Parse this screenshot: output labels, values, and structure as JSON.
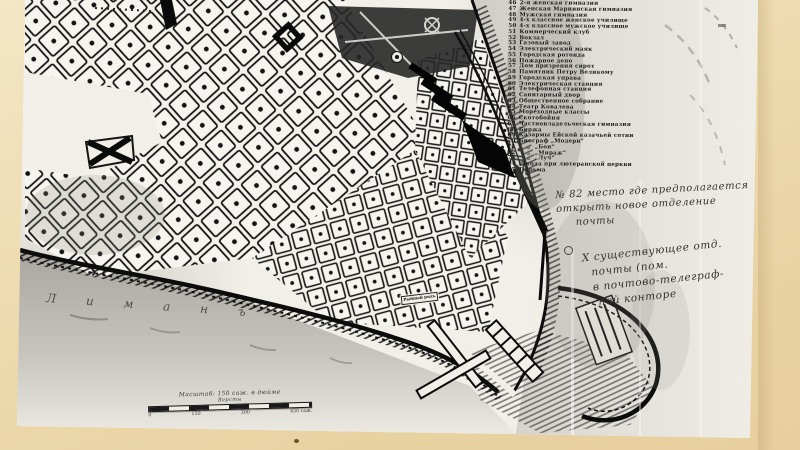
{
  "colors": {
    "mat_cream": "#eedbaf",
    "photo_white": "#f1efe8",
    "map_ink": "#111111",
    "sea_gray": "#d5d3cc",
    "water_gray": "#aeaca5",
    "handwriting": "#34322e"
  },
  "legend": {
    "items": [
      {
        "num": "46",
        "label": "2-я женская гимназия"
      },
      {
        "num": "47",
        "label": "Женская Мариинская гимназия"
      },
      {
        "num": "48",
        "label": "Мужская гимназия"
      },
      {
        "num": "49",
        "label": "4-х классное женское училище"
      },
      {
        "num": "50",
        "label": "4-х классное мужское училище"
      },
      {
        "num": "51",
        "label": "Коммерческий клуб"
      },
      {
        "num": "52",
        "label": "Вокзал"
      },
      {
        "num": "53",
        "label": "Газовый завод"
      },
      {
        "num": "54",
        "label": "Электрический маяк"
      },
      {
        "num": "55",
        "label": "Городская ротонда"
      },
      {
        "num": "56",
        "label": "Пожарное депо"
      },
      {
        "num": "57",
        "label": "Дом призрения сирот"
      },
      {
        "num": "58",
        "label": "Памятник Петру Великому"
      },
      {
        "num": "59",
        "label": "Городская управа"
      },
      {
        "num": "60",
        "label": "Электрическая станция"
      },
      {
        "num": "61",
        "label": "Телефонная станция"
      },
      {
        "num": "62",
        "label": "Санитарный двор"
      },
      {
        "num": "63",
        "label": "Общественное собрание"
      },
      {
        "num": "64",
        "label": "Театр Ковалева"
      },
      {
        "num": "65",
        "label": "Мореходные классы"
      },
      {
        "num": "66",
        "label": "Скотобойня"
      },
      {
        "num": "67",
        "label": "Частновладельческая гимназия"
      },
      {
        "num": "68",
        "label": "Биржа"
      },
      {
        "num": "69",
        "label": "Казармы Ейской казачьей сотни"
      },
      {
        "num": "70",
        "label": "Биограф „Модерн“"
      },
      {
        "num": "71",
        "label": "    „  „Бон“"
      },
      {
        "num": "72",
        "label": "    „  „Мираж“"
      },
      {
        "num": "73",
        "label": "    „  „Луч“"
      },
      {
        "num": "74",
        "label": "Школа при лютеранской церкви"
      },
      {
        "num": "75",
        "label": "Тюрьма"
      }
    ]
  },
  "notes": {
    "block1": {
      "lines": [
        "№ 82  место где предполагается",
        "открыть новое отделение",
        "     почты"
      ]
    },
    "block2": {
      "lines": [
        "Х существующее отд.",
        "  почты (пом.",
        "  в почтово-телеграф-",
        "   ной конторе"
      ]
    }
  },
  "water": {
    "letters": [
      "Л",
      "и",
      "м",
      "а",
      "н",
      "ъ"
    ]
  },
  "map_labels": {
    "fish_market": "Рыбный рядъ"
  },
  "scale": {
    "title": "Масштаб: 150 саж. в дюйме",
    "sub": "Версты",
    "ticks": [
      "0",
      "150",
      "300",
      "450 саж."
    ]
  }
}
